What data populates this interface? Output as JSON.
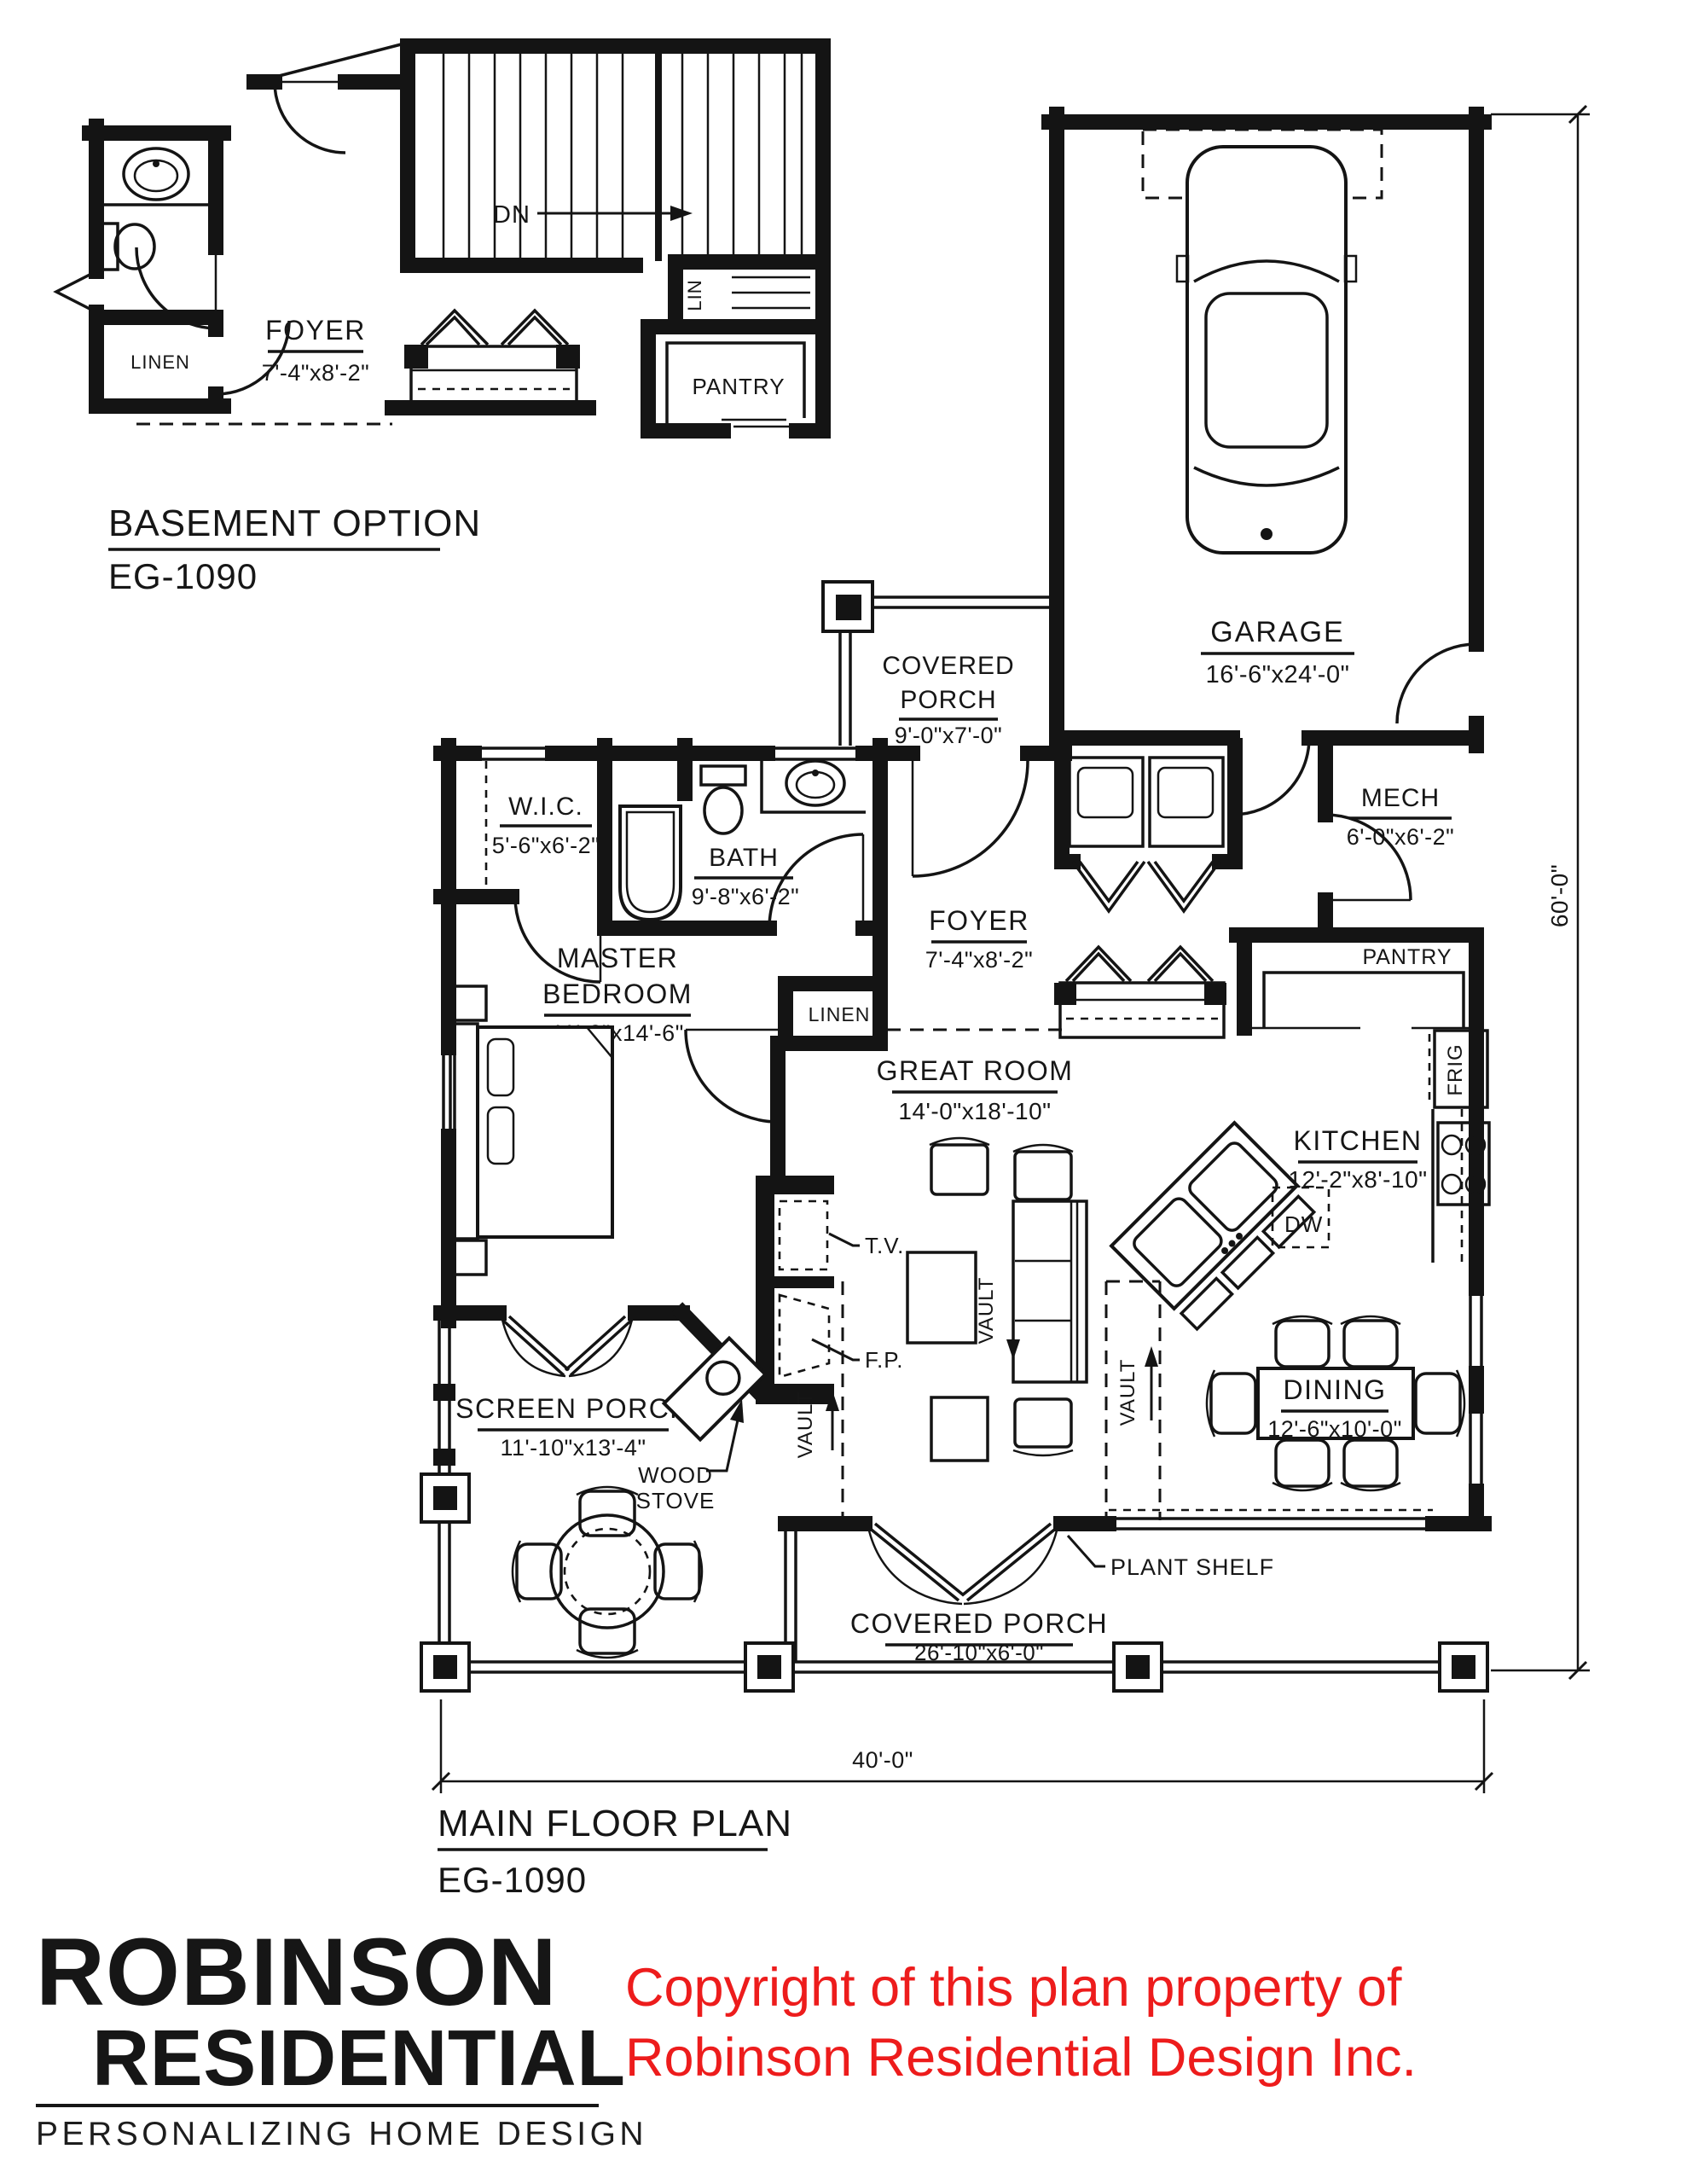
{
  "plan_titles": {
    "basement": {
      "label": "BASEMENT OPTION",
      "code": "EG-1090"
    },
    "main": {
      "label": "MAIN FLOOR PLAN",
      "code": "EG-1090"
    }
  },
  "basement": {
    "dn": "DN",
    "foyer_label": "FOYER",
    "foyer_dims": "7'-4\"x8'-2\"",
    "linen": "LINEN",
    "lin": "LIN",
    "pantry": "PANTRY"
  },
  "main": {
    "garage_label": "GARAGE",
    "garage_dims": "16'-6\"x24'-0\"",
    "covered_porch_top_l1": "COVERED",
    "covered_porch_top_l2": "PORCH",
    "covered_porch_top_dims": "9'-0\"x7'-0\"",
    "wic_label": "W.I.C.",
    "wic_dims": "5'-6\"x6'-2\"",
    "bath_label": "BATH",
    "bath_dims": "9'-8\"x6'-2\"",
    "mech_label": "MECH",
    "mech_dims": "6'-0\"x6'-2\"",
    "foyer_label": "FOYER",
    "foyer_dims": "7'-4\"x8'-2\"",
    "linen": "LINEN",
    "pantry": "PANTRY",
    "frig": "FRIG",
    "dw": "DW",
    "tv": "T.V.",
    "fp": "F.P.",
    "vault": "VAULT",
    "master_l1": "MASTER",
    "master_l2": "BEDROOM",
    "master_dims": "11'-2\"x14'-6\"",
    "great_label": "GREAT ROOM",
    "great_dims": "14'-0\"x18'-10\"",
    "kitchen_label": "KITCHEN",
    "kitchen_dims": "12'-2\"x8'-10\"",
    "screen_label": "SCREEN PORCH",
    "screen_dims": "11'-10\"x13'-4\"",
    "wood_l1": "WOOD",
    "wood_l2": "STOVE",
    "dining_label": "DINING",
    "dining_dims": "12'-6\"x10'-0\"",
    "plant_shelf": "PLANT SHELF",
    "covered_porch_bottom_label": "COVERED PORCH",
    "covered_porch_bottom_dims": "26'-10\"x6'-0\""
  },
  "dimensions": {
    "overall_width": "40'-0\"",
    "overall_height": "60'-0\""
  },
  "logo": {
    "line1": "ROBINSON",
    "line2": "RESIDENTIAL",
    "tagline": "PERSONALIZING HOME DESIGN"
  },
  "copyright": {
    "line1": "Copyright of this plan property of",
    "line2": "Robinson Residential Design Inc.",
    "color": "#ed1c1c"
  },
  "colors": {
    "ink": "#141414",
    "paper": "#ffffff",
    "copyright_red": "#ed1c1c"
  }
}
